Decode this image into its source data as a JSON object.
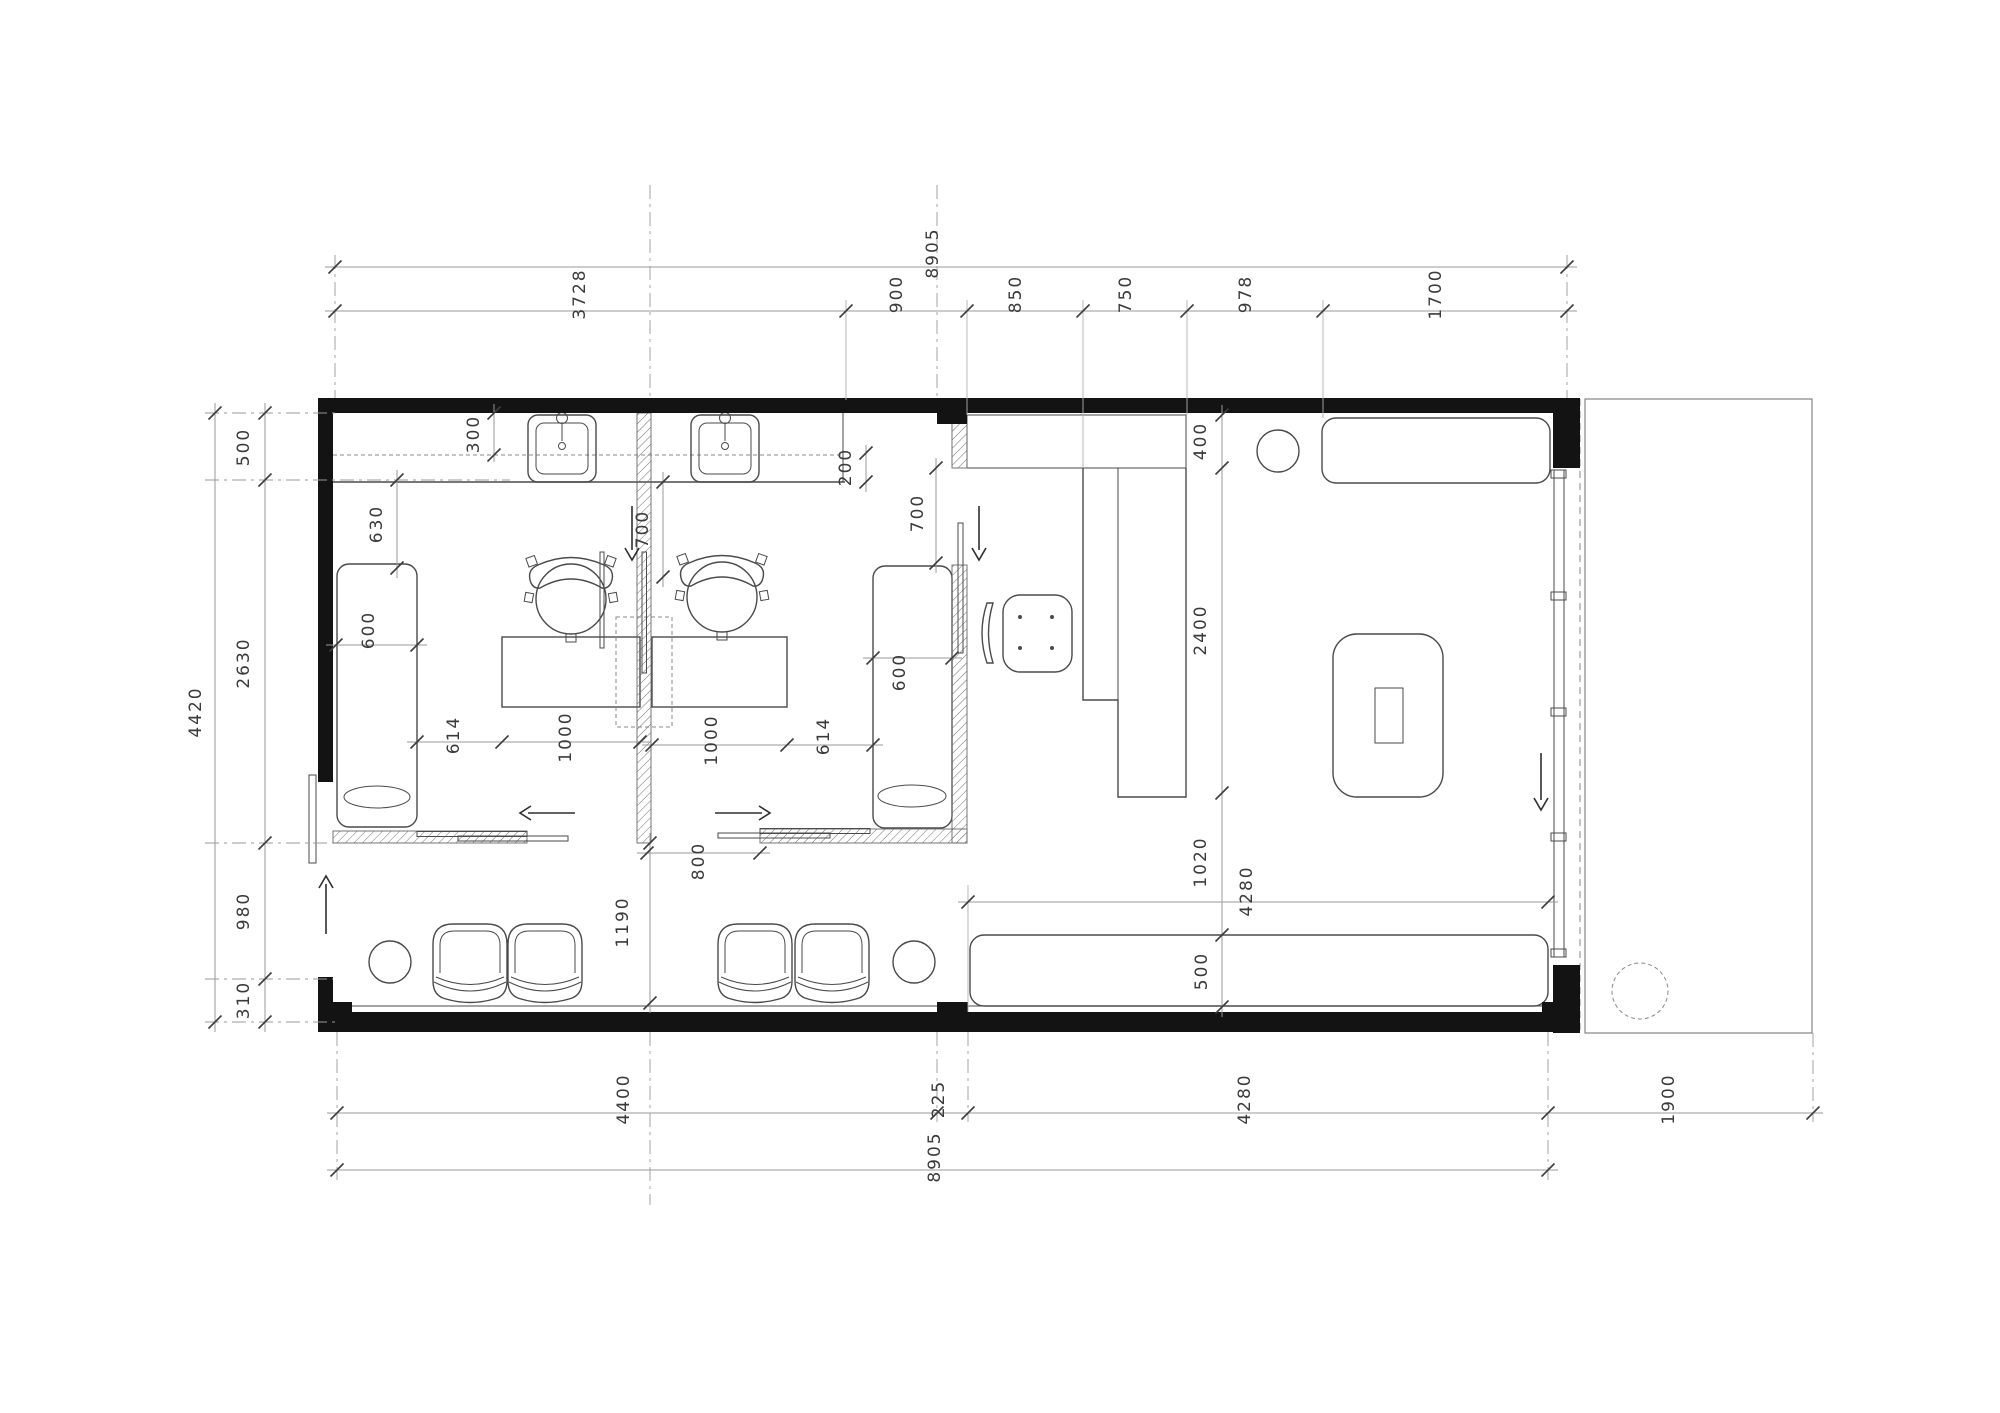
{
  "dims": {
    "top": {
      "total": "8905",
      "segments": [
        "3728",
        "900",
        "850",
        "750",
        "978",
        "1700"
      ]
    },
    "left": {
      "total": "4420",
      "segments": [
        "500",
        "2630",
        "980",
        "310"
      ]
    },
    "bottom": {
      "total": "8905",
      "segments": [
        "4400",
        "225",
        "4280",
        "1900"
      ]
    },
    "interior": {
      "shelf_depth": "300",
      "counter_front": "200",
      "bench1_offset": "630",
      "bench1_width": "600",
      "room1_clear": "700",
      "room1_side": "614",
      "room1_table": "1000",
      "room2_table": "1000",
      "room2_side": "614",
      "bench2_width": "600",
      "office_door": "700",
      "room_door": "800",
      "waiting_depth": "1190",
      "counter_back": "400",
      "desk_length": "2400",
      "lounge_clear": "1020",
      "lounge_bench": "500",
      "lounge_width": "4280"
    }
  }
}
